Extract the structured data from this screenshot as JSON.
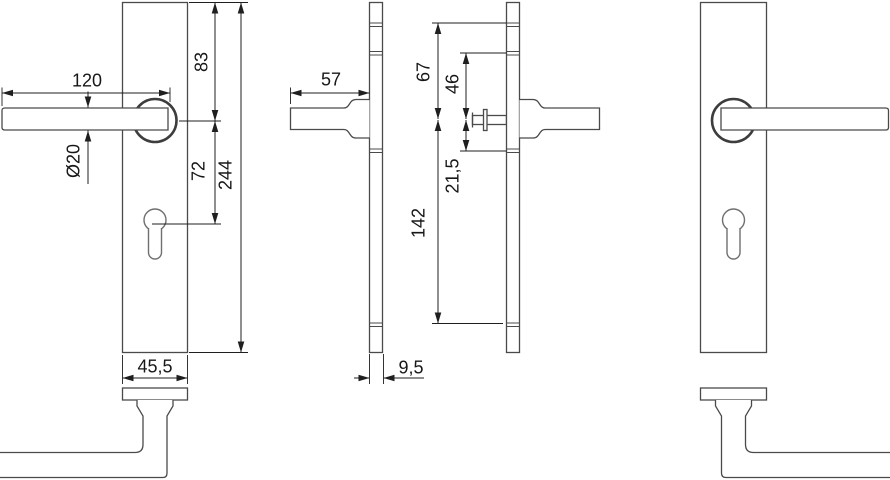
{
  "drawing": {
    "type": "technical-dimension-drawing",
    "subject": "lever door handle on long backplate with euro profile cylinder cutout, front / side / bottom views",
    "background": "#ffffff",
    "line_color": "#4a4a4a",
    "dimension_color": "#1f1f1f",
    "dims": {
      "lever_length": "120",
      "plate_top_to_handle": "83",
      "handle_to_cylinder": "72",
      "plate_length": "244",
      "lever_diameter": "Ø20",
      "plate_width": "45,5",
      "handle_projection": "57",
      "hole1_to_spindle": "67",
      "hole2_to_spindle": "46",
      "spindle_to_hole3": "21,5",
      "spindle_to_hole4": "142",
      "plate_thickness": "9,5"
    }
  }
}
